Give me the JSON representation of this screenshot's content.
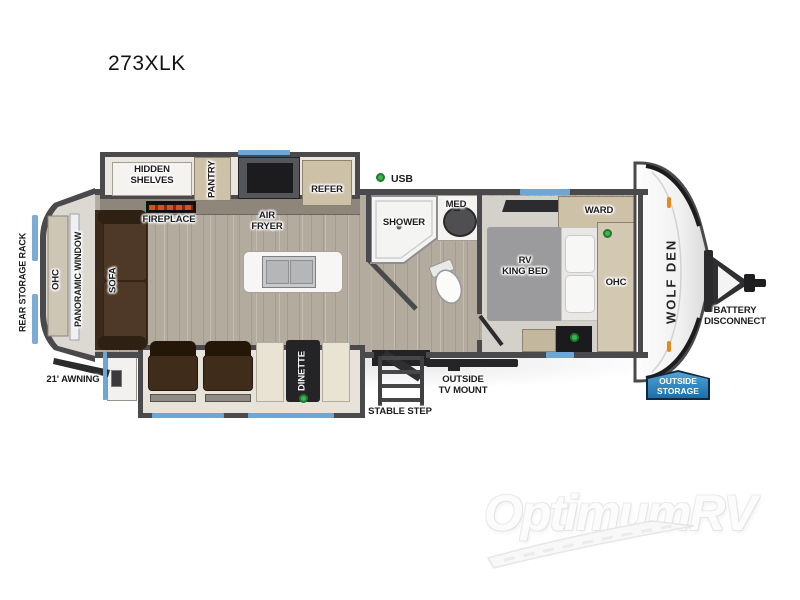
{
  "title": "273XLK",
  "watermark": {
    "brand": "OptimumRV"
  },
  "trailer": {
    "brand_logo": "WOLF DEN",
    "exterior": {
      "usb": "USB",
      "awning": "21' AWNING",
      "rear_storage_rack": "REAR STORAGE RACK",
      "outside_tv_mount": "OUTSIDE\nTV MOUNT",
      "stable_step": "STABLE STEP",
      "battery_disconnect": "BATTERY\nDISCONNECT",
      "outside_storage": "OUTSIDE\nSTORAGE"
    },
    "kitchen": {
      "hidden_shelves": "HIDDEN\nSHELVES",
      "pantry": "PANTRY",
      "refer": "REFER",
      "fireplace": "FIREPLACE",
      "air_fryer": "AIR\nFRYER"
    },
    "bathroom": {
      "shower": "SHOWER",
      "med": "MED"
    },
    "bedroom": {
      "ward": "WARD",
      "bed": "RV\nKING BED",
      "ohc": "OHC"
    },
    "living": {
      "sofa": "SOFA",
      "panoramic_window": "PANORAMIC WINDOW",
      "ohc": "OHC",
      "dinette": "DINETTE"
    }
  },
  "colors": {
    "wall": "#4a4a4c",
    "floor_wood": "#b4ab9f",
    "slide_interior": "#e9e6e0",
    "cabinet_tan": "#cdc1a8",
    "sofa_brown": "#46321f",
    "bed_gray": "#9b9b9d",
    "window_blue": "#6fa7d4",
    "indicator_green": "#3cb54a",
    "badge_blue": "#2277b4"
  }
}
